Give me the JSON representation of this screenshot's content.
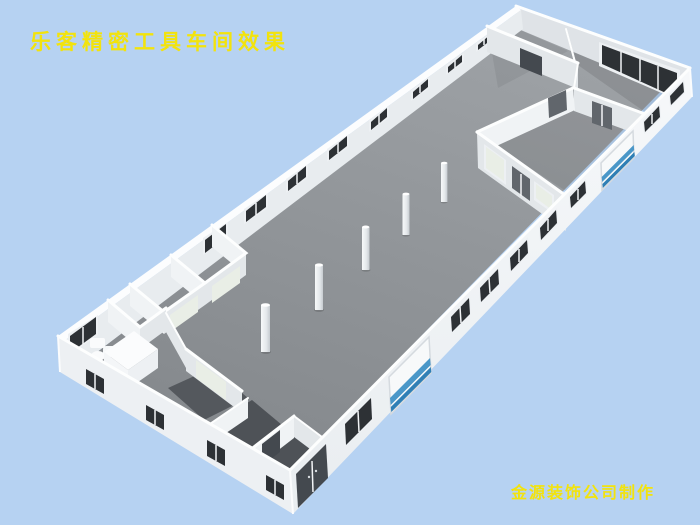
{
  "title": {
    "text": "乐客精密工具车间效果",
    "color": "#F2E30D"
  },
  "credit": {
    "text": "金源装饰公司制作",
    "color": "#F2E30D"
  },
  "scene": {
    "description": "3D overhead render of a roofless precision tool workshop floor plan",
    "background": "#B6D2F2",
    "floor_color": "#8F9397",
    "dark_room_floor_color": "#53575C",
    "wall_color": "#F0F3F5",
    "wall_shade_color": "#E3E7EA",
    "wall_top_color": "#FDFEFE",
    "window_color": "#2D3135",
    "door_color": "#61666C",
    "frosted_glass_color": "#E9EEE6",
    "roller_door_stripe_color": "#4A97C8",
    "column_count": 5
  }
}
